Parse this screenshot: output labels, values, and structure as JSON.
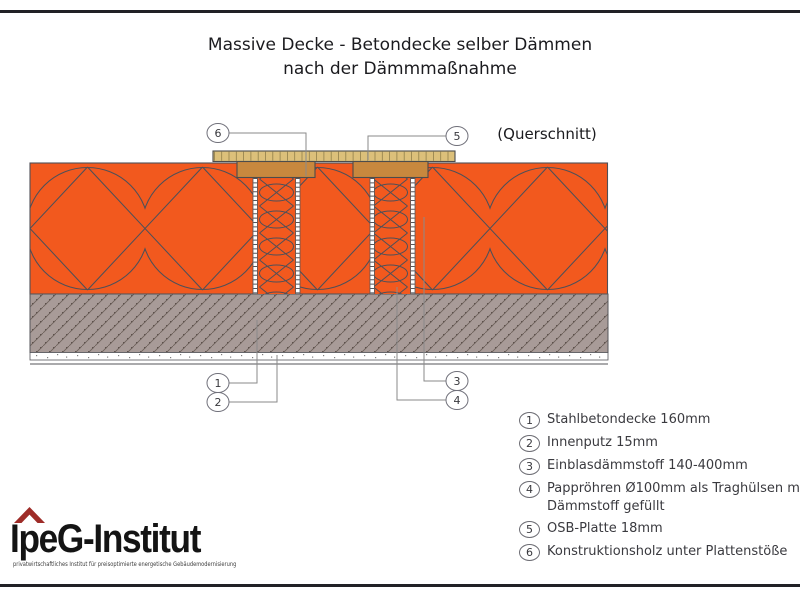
{
  "title": {
    "line1": "Massive Decke - Betondecke selber Dämmen",
    "line2": "nach der Dämmmaßnahme"
  },
  "view_label": "(Querschnitt)",
  "callouts": {
    "c1": "1",
    "c2": "2",
    "c3": "3",
    "c4": "4",
    "c5": "5",
    "c6": "6"
  },
  "legend": {
    "items": [
      {
        "num": "1",
        "text": "Stahlbetondecke 160mm"
      },
      {
        "num": "2",
        "text": "Innenputz 15mm"
      },
      {
        "num": "3",
        "text": "Einblasdämmstoff 140-400mm"
      },
      {
        "num": "4",
        "text": "Pappröhren Ø100mm als Traghülsen mit Dämmstoff gefüllt"
      },
      {
        "num": "5",
        "text": "OSB-Platte 18mm"
      },
      {
        "num": "6",
        "text": "Konstruktionsholz unter Plattenstöße"
      }
    ]
  },
  "logo": {
    "name": "IpeG-Institut",
    "tagline": "privatwirtschaftliches Institut für preisoptimierte energetische Gebäudemodernisierung"
  },
  "colors": {
    "insulation_orange": "#F2591E",
    "outline_dark": "#4F4F57",
    "concrete_gray": "#A89B98",
    "osb_tan": "#DCC07A",
    "wood_brown": "#C8883E",
    "logo_red": "#9E2C28"
  }
}
